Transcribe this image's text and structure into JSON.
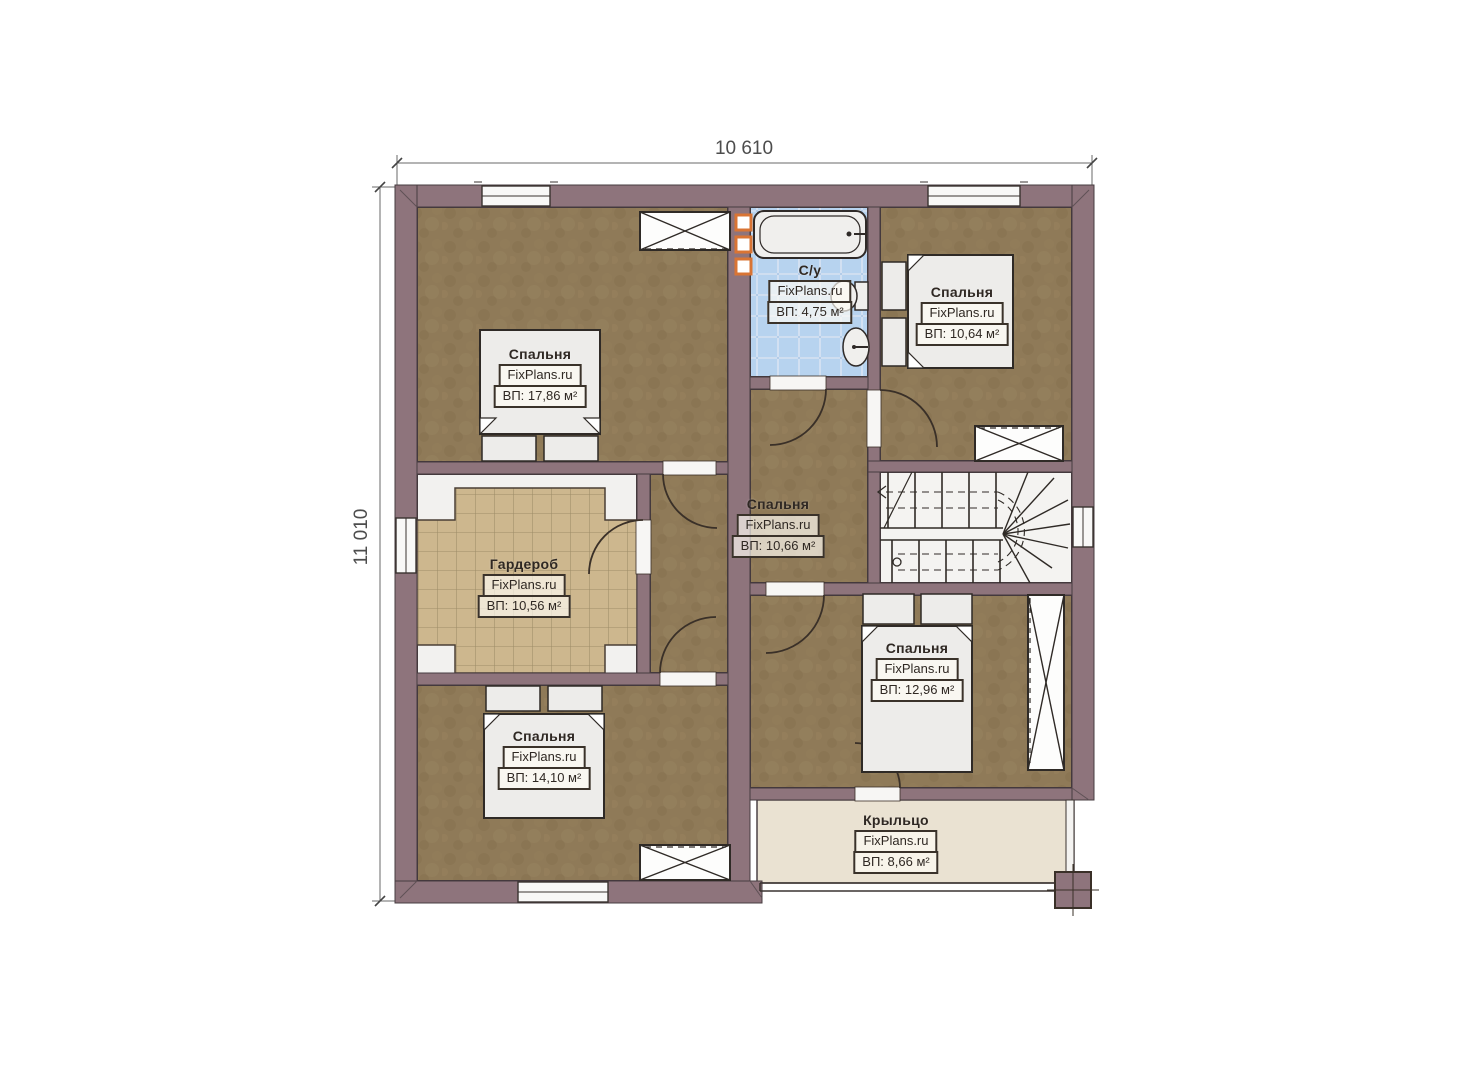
{
  "plan": {
    "dim_width": "10 610",
    "dim_height": "11 010",
    "rooms": [
      {
        "name": "Спальня",
        "brand": "FixPlans.ru",
        "area": "ВП: 17,86 м²"
      },
      {
        "name": "С/у",
        "brand": "FixPlans.ru",
        "area": "ВП: 4,75 м²"
      },
      {
        "name": "Спальня",
        "brand": "FixPlans.ru",
        "area": "ВП: 10,64 м²"
      },
      {
        "name": "Гардероб",
        "brand": "FixPlans.ru",
        "area": "ВП: 10,56 м²"
      },
      {
        "name": "Спальня",
        "brand": "FixPlans.ru",
        "area": "ВП: 10,66 м²"
      },
      {
        "name": "Спальня",
        "brand": "FixPlans.ru",
        "area": "ВП: 12,96 м²"
      },
      {
        "name": "Спальня",
        "brand": "FixPlans.ru",
        "area": "ВП: 14,10 м²"
      },
      {
        "name": "Крыльцо",
        "brand": "FixPlans.ru",
        "area": "ВП: 8,66 м²"
      }
    ],
    "colors": {
      "wall": "#8e747c",
      "outline": "#3a3028",
      "floor_bedroom": "#8f7a58",
      "floor_wardrobe_tile": "#cdb78e",
      "floor_bathroom_tile": "#b7d3ef",
      "floor_porch": "#eae2d2",
      "vent_accent": "#d97434"
    }
  }
}
